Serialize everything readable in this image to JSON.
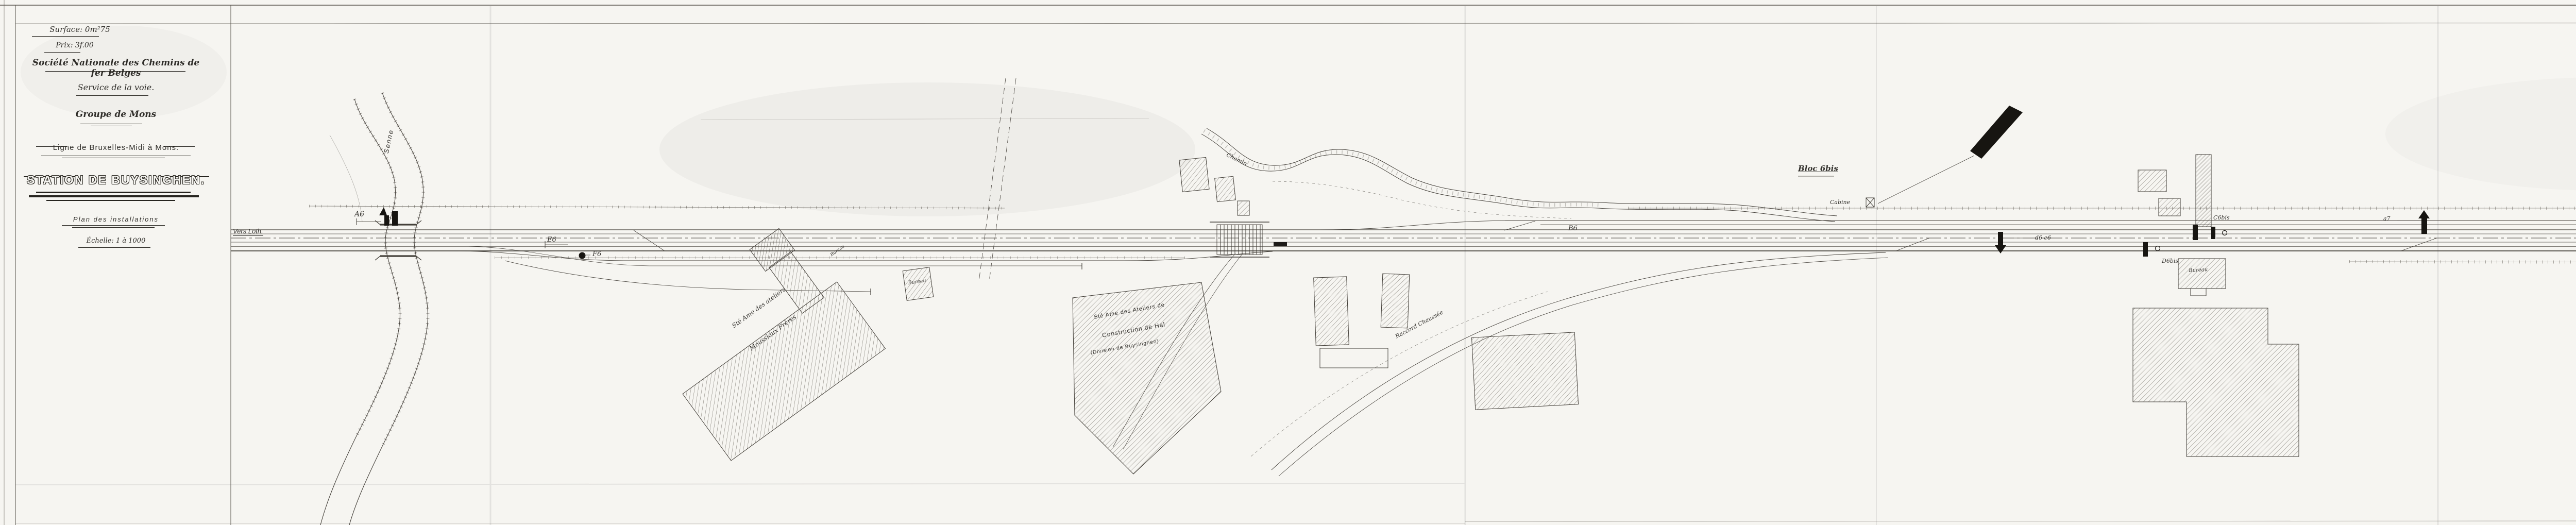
{
  "document": {
    "type": "railway installation plan (scanned ink drawing)",
    "paper_color": "#f6f5f1",
    "ink_color": "#3a3833"
  },
  "title_block": {
    "surface": "Surface: 0m²75",
    "price": "Prix: 3f.00",
    "company": "Société Nationale des Chemins de fer Belges",
    "service": "Service de la voie.",
    "group": "Groupe de Mons",
    "line": "Ligne de Bruxelles-Midi à Mons.",
    "station": "STATION DE BUYSINGHEN.",
    "subtitle": "Plan des installations",
    "scale": "Échelle: 1 à 1000"
  },
  "labels": {
    "vers_loth": "Vers Loth.",
    "vers_hal": "Vers Hal",
    "senne": "Senne",
    "sig_a6": "A6",
    "sig_e6": "E6",
    "sig_f6": "F6",
    "sig_b6": "B6",
    "bloc6bis": "Bloc 6bis",
    "cabine6": "Cabine",
    "sig_d6e6": "d6 e6",
    "sig_c6bis": "C6bis",
    "sig_d6bis": "D6bis",
    "sig_a7_small": "a7",
    "sig_a7": "A7",
    "sig_f7": "F7",
    "bloc7": "Bloc 7",
    "cabine7": "CABINE",
    "quai": "Quai",
    "abri": "ABRI",
    "recettes": "RECETTES",
    "wc": "W.C.",
    "jardin": "Jardin",
    "route_15": "N° 15",
    "magasin": "MAGASIN",
    "charbon": "charbon",
    "pb": "P.B.",
    "sable": "Sable",
    "cour_petrole": "Cour à pétrole",
    "loge_piocheurs": "Loge piocheurs",
    "cour_marchandises": "Cour aux marchandises",
    "moussiaux1": "Sté Ame des ateliers",
    "moussiaux2": "Moussiaux Frères",
    "bureau1": "Bureau",
    "bureau2": "Bureau",
    "bureau3": "Bureau",
    "hal1": "Sté Ame des Ateliers de",
    "hal2": "Construction de Hal",
    "hal3": "(Division de Buysinghen)",
    "chemin": "Chemin",
    "raccord": "Raccord Chaussée",
    "bc": "B.C."
  }
}
